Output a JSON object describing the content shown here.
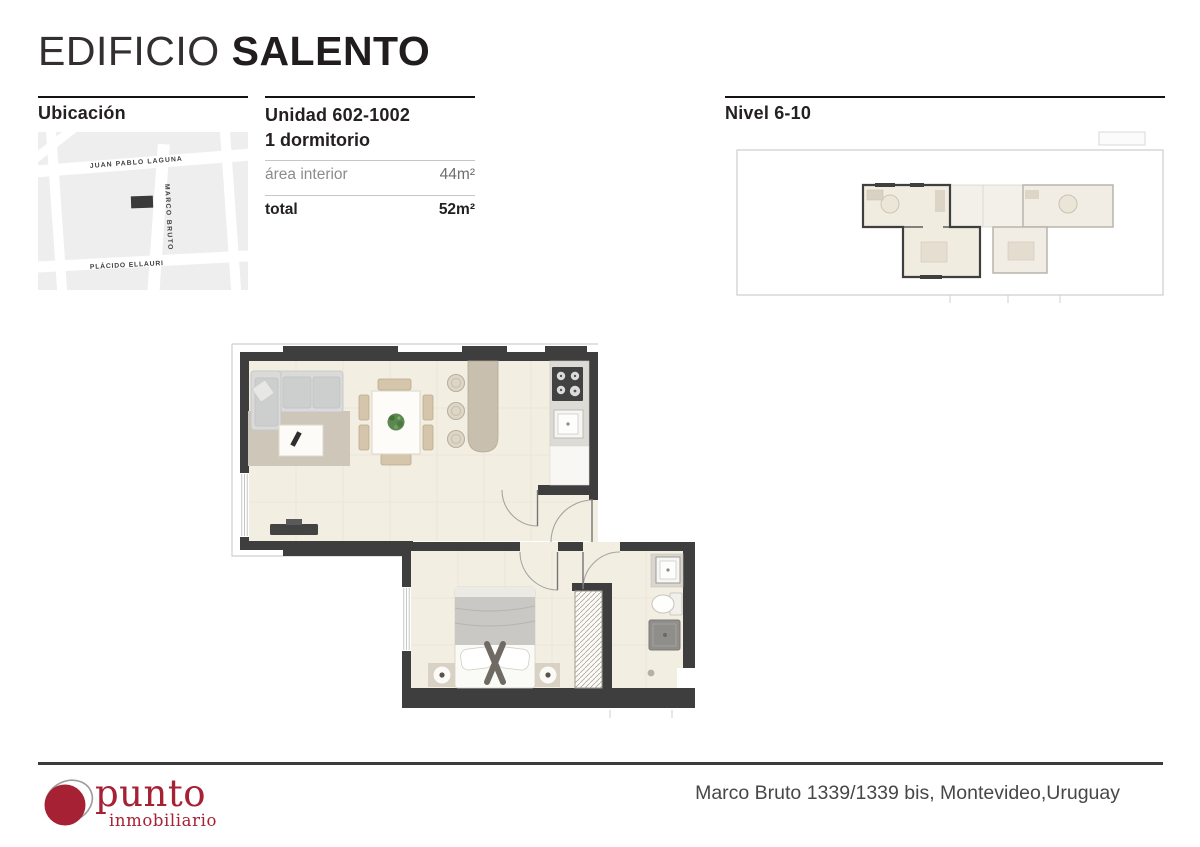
{
  "header": {
    "title_light": "EDIFICIO",
    "title_bold": "SALENTO"
  },
  "location": {
    "heading": "Ubicación",
    "street_top": "JUAN PABLO LAGUNA",
    "street_vertical": "MARCO BRUTO",
    "street_bottom": "PLÁCIDO ELLAURI"
  },
  "unit": {
    "title": "Unidad 602-1002",
    "subtitle": "1 dormitorio",
    "rows": [
      {
        "label": "área interior",
        "value": "44m²"
      },
      {
        "label": "total",
        "value": "52m²"
      }
    ]
  },
  "level": {
    "heading": "Nivel 6-10"
  },
  "footer": {
    "brand": "punto",
    "brand_sub": "inmobiliario",
    "address": "Marco Bruto 1339/1339 bis, Montevideo,Uruguay"
  },
  "colors": {
    "wall": "#3e3e3e",
    "floor": "#f3eee2",
    "brand_red": "#a72135",
    "heading_dark": "#242021"
  }
}
